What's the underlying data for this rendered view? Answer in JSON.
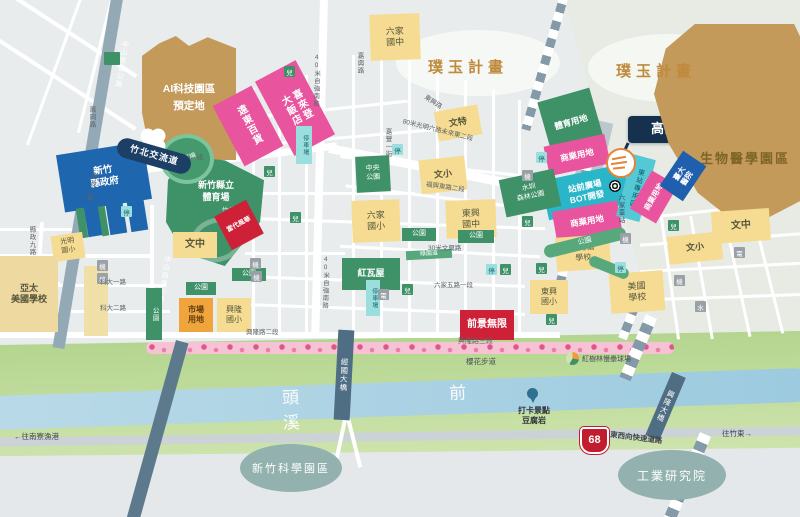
{
  "region_labels": {
    "puyu": "璞玉計畫",
    "biomedical": "生物醫學園區",
    "science_park": "新竹科學園區",
    "itri": "工業研究院",
    "river": "頭前溪"
  },
  "station": {
    "hsr": "高鐵新竹車站",
    "liujia": "六家車站",
    "east_station_zone": "東站專用區"
  },
  "zones": {
    "ai_park": "AI科技園區\n預定地",
    "fareast": "遠東百貨",
    "sheraton": "喜來登\n大飯店",
    "county_gov": "新竹\n縣政府",
    "stadium": "新竹縣立\n體育場",
    "sports_center": "竹北國民\n運動中心",
    "track_field": "田徑場",
    "project_red": "當代風華",
    "qianjing": "前景無限",
    "commercial": "商業用地",
    "bot": "站前廣場\nBOT開發",
    "sports_land": "體育用地",
    "forest_park": "水圳\n森林公園",
    "central_park": "中央\n公園",
    "market": "市場\n用地",
    "redbrick": "紅瓦屋",
    "ntu_hospital": "臺大\n醫院",
    "greenway": "綠園道",
    "park": "公園"
  },
  "schools": {
    "wenzhong": "文中",
    "wenxiao": "文小",
    "wente": "文特",
    "guangming": "光明\n國小",
    "asia_pacific": "亞太\n美國學校",
    "xinglong": "興隆\n國小",
    "liujia_jh": "六家\n國中",
    "liujia_es": "六家\n國小",
    "dongxing_jh": "東興\n國中",
    "dongxing_es": "東興\n國小",
    "cornell": "康乃薾\n學校",
    "american": "美國\n學校"
  },
  "roads": {
    "zhongshan": "中山高速公路",
    "ziqiang": "40米自強南路",
    "guangming6_w": "光明六路東一段",
    "guangming6_e": "80米光明六路未來東二段",
    "xianzheng9": "縣政九路",
    "xianzheng2": "縣政二路",
    "fenggang": "鳳岡路",
    "keda1": "科大一路",
    "keda2": "科大二路",
    "jiaxing": "嘉興路",
    "jiafeng1": "嘉豐一街",
    "fuxing_e2": "福興東路二段",
    "dongxing_rd": "東興路",
    "wenxing30": "30米文興路",
    "liujia5": "六家五路一段",
    "xinglong2": "興隆路二段",
    "xinglong3": "興隆路三段",
    "expressway": "東西向快速道路",
    "route68": "68",
    "interchange": "竹北交流道"
  },
  "bridges": {
    "jingguo": "經國大橋",
    "xinglong_bridge": "興隆大橋"
  },
  "pois": {
    "sakura": "櫻花步道",
    "softball": "紅樹林慢壘球場",
    "tofu": "打卡景點\n豆腐岩",
    "to_zhudong": "往竹東→",
    "to_nanliao": "←往南寮漁港"
  },
  "micro": {
    "parking_lot": "停車場",
    "stop": "停",
    "child": "兒",
    "machine": "機",
    "power": "電",
    "water": "水"
  },
  "colors": {
    "school_yellow": "#f5dc92",
    "park_green": "#3f9168",
    "commercial_pink": "#e8559e",
    "government_blue": "#1e66ae",
    "project_red": "#ce2137",
    "bot_cyan": "#29b6c8",
    "land_tan": "#c49a5b",
    "market_orange": "#f0a43c",
    "parking_teal": "#9adedd",
    "river_blue": "#a8d0e2",
    "flood_green": "#bcd99a",
    "sakura_pink": "#f5c3d3",
    "highway_slate": "#93a9b6",
    "hsr_navy": "#16314d",
    "puyu_text": "#c08a3e",
    "route68_red": "#c21d2e"
  }
}
